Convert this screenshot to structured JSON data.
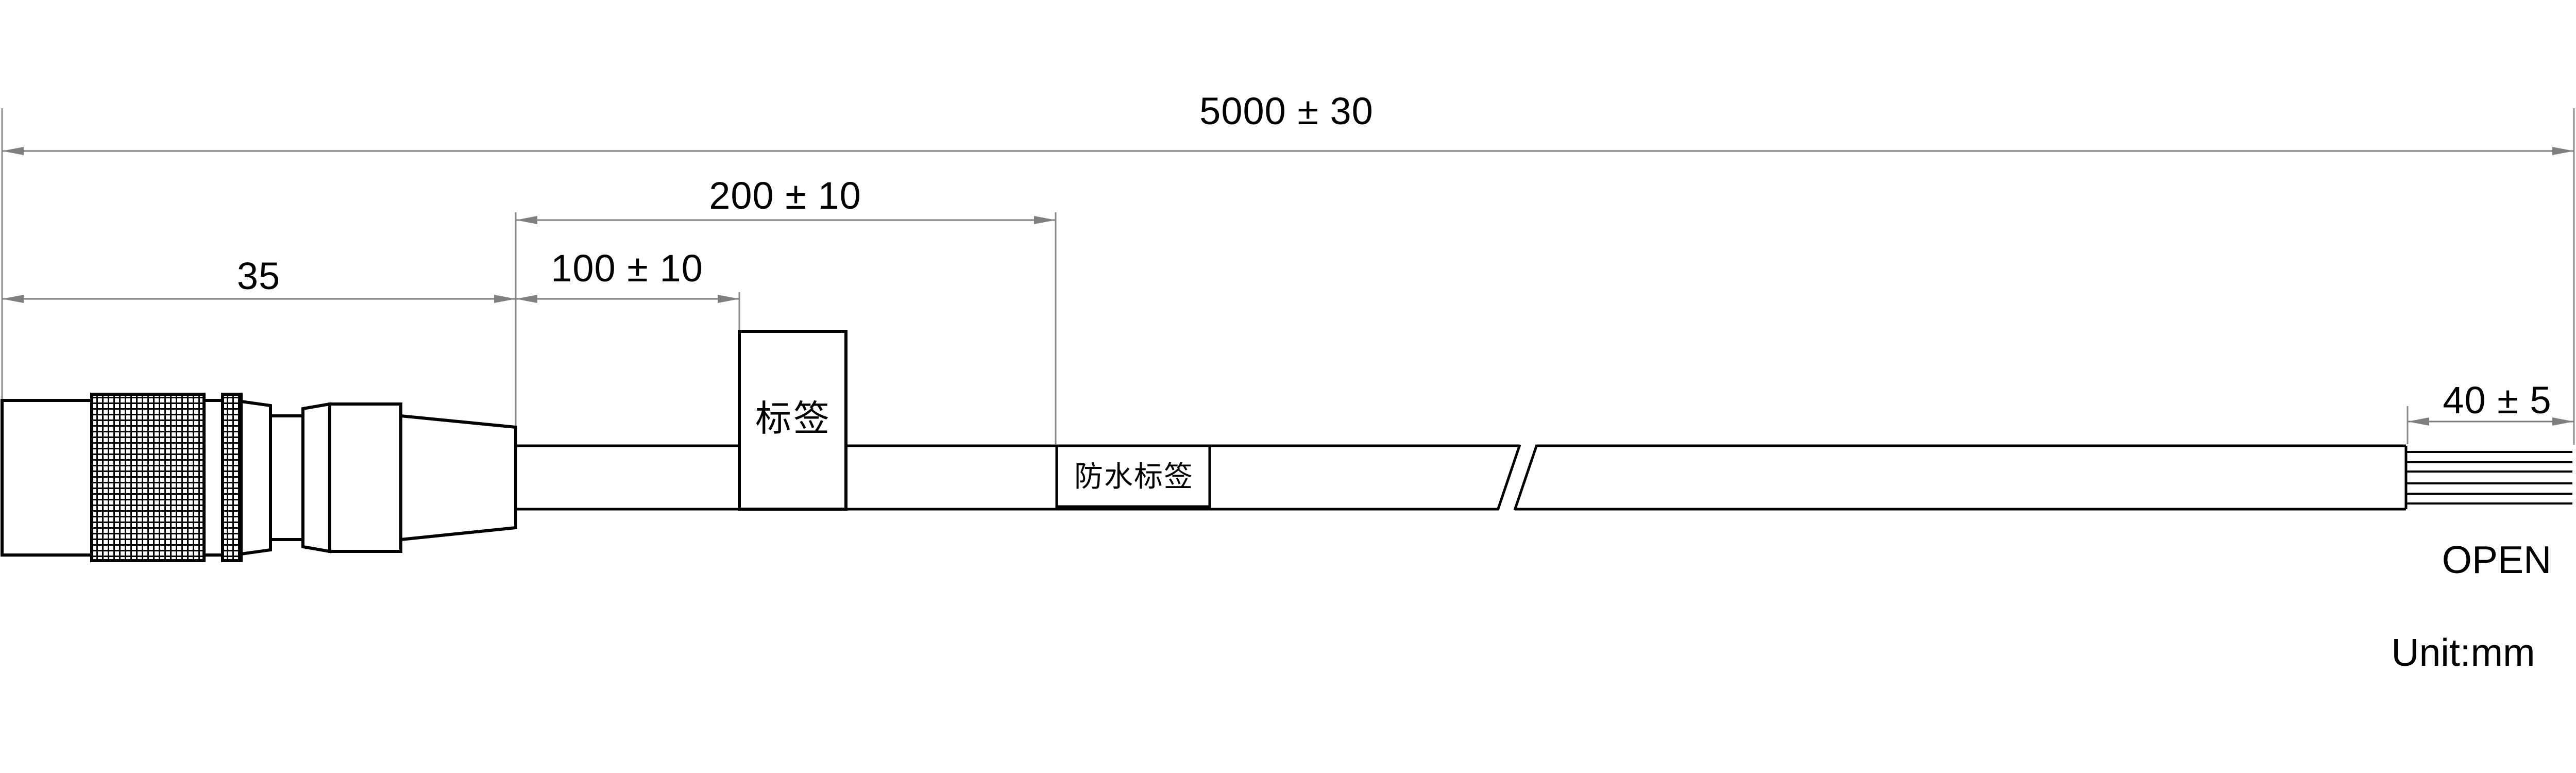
{
  "drawing": {
    "background": "#ffffff",
    "outline_color": "#000000",
    "dimension_color": "#7f7f7f",
    "dimensions": {
      "overall": "5000 ± 30",
      "label_span": "200 ± 10",
      "connector": "35",
      "label_offset": "100 ± 10",
      "strip": "40 ± 5"
    },
    "tags": {
      "label": "标签",
      "waterproof_label": "防水标签"
    },
    "end_label": "OPEN",
    "unit_note": "Unit:mm"
  }
}
